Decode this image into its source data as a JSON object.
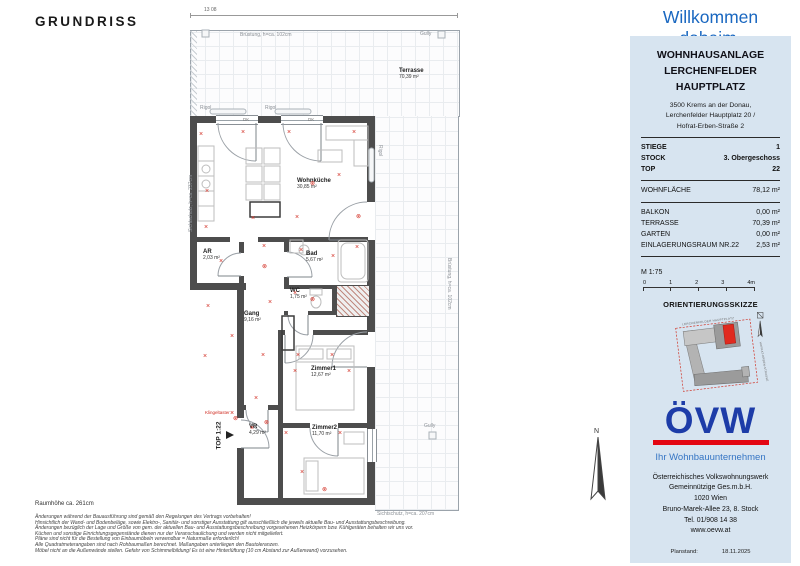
{
  "header": {
    "title": "GRUNDRISS",
    "welcome": "Willkommen daheim."
  },
  "plan": {
    "dimension_top": "13 08",
    "terrace": {
      "name": "Terrasse",
      "area": "70,39 m²"
    },
    "rooms": [
      {
        "name": "Wohnküche",
        "area": "30,85 m²"
      },
      {
        "name": "AR",
        "area": "2,03 m²"
      },
      {
        "name": "Bad",
        "area": "5,67 m²"
      },
      {
        "name": "WC",
        "area": "1,75 m²"
      },
      {
        "name": "Gang",
        "area": "9,16 m²"
      },
      {
        "name": "Zimmer1",
        "area": "12,67 m²"
      },
      {
        "name": "VR",
        "area": "4,29 m²"
      },
      {
        "name": "Zimmer2",
        "area": "11,70 m²"
      }
    ],
    "labels": {
      "bruestung_top": "Brüstung, h=ca. 102cm",
      "sichtschutz_left": "Sichtschutz, h=ca. 237cm",
      "sichtschutz_bottom": "Sichtschutz, h=ca. 207cm",
      "bruestung_right": "Brüstung, h=ca. 102cm",
      "gully": "Gully",
      "rigol": "Rigol",
      "dk": "DK",
      "top_entry": "TOP 1:22",
      "klingel": "Klingeltaster",
      "north": "N"
    }
  },
  "footnotes": {
    "room_height": "Raumhöhe ca. 261cm",
    "lines": [
      "Änderungen während der Bauausführung sind gemäß den Regelungen des Vertrags vorbehalten!",
      "Hinsichtlich der Wand- und Bodenbeläge, sowie Elektro-, Sanitär- und sonstiger Ausstattung gilt ausschließlich die jeweils aktuelle Bau- und Ausstattungsbeschreibung.",
      "Änderungen bezüglich der Lage und Größe von gem. der aktuellen Bau- und Ausstattungsbeschreibung vorgesehenen Heizkörpern bzw. Kühlgeräten behalten wir uns vor.",
      "Küchen und sonstige Einrichtungsgegenstände dienen nur der Veranschaulichung und werden nicht mitgeliefert.",
      "Pläne sind nicht für die Bestellung von Einbaumöbeln verwendbar = Naturmaße erforderlich!",
      "Alle Quadratmeterangaben sind nach Rohbaumaßen berechnet. Maßangaben unterliegen den Bautoleranzen.",
      "Möbel nicht an die Außenwände stellen. Gefahr von Schimmelbildung! Es ist eine Hinterlüftung (10 cm Abstand zur Außenwand) vorzusehen."
    ]
  },
  "panel": {
    "project_line1": "WOHNHAUSANLAGE",
    "project_line2": "LERCHENFELDER HAUPTPLATZ",
    "address": [
      "3500 Krems an der Donau,",
      "Lerchenfelder Hauptplatz 20 /",
      "Hofrat-Erben-Straße 2"
    ],
    "unit_rows": [
      {
        "label": "STIEGE",
        "value": "1"
      },
      {
        "label": "STOCK",
        "value": "3. Obergeschoss"
      },
      {
        "label": "TOP",
        "value": "22"
      }
    ],
    "living_row": {
      "label": "WOHNFLÄCHE",
      "value": "78,12 m²"
    },
    "extra_rows": [
      {
        "label": "BALKON",
        "value": "0,00 m²"
      },
      {
        "label": "TERRASSE",
        "value": "70,39 m²"
      },
      {
        "label": "GARTEN",
        "value": "0,00 m²"
      },
      {
        "label": "EINLAGERUNGSRAUM NR.22",
        "value": "2,53 m²"
      }
    ],
    "scale": {
      "label": "M 1:75",
      "ticks": [
        "0",
        "1",
        "2",
        "3",
        "4m"
      ]
    },
    "orientation": {
      "title": "ORIENTIERUNGSSKIZZE",
      "street_top": "LERCHENFELDER HAUPTPLATZ",
      "street_right": "HOFRAT-ERBEN-STRASSE"
    },
    "logo": {
      "text": "ÖVW",
      "tagline": "Ihr Wohnbauunternehmen"
    },
    "company": [
      "Österreichisches Volkswohnungswerk",
      "Gemeinnützige Ges.m.b.H.",
      "1020 Wien",
      "Bruno-Marek-Allee 23, 8. Stock",
      "Tel. 01/908 14 38",
      "www.oevw.at"
    ],
    "planstand": {
      "label": "Planstand:",
      "value": "18.11.2025"
    }
  },
  "colors": {
    "panel_bg": "#d7e4f0",
    "accent_blue": "#1967c0",
    "logo_blue": "#1d3ca8",
    "logo_red": "#e30613",
    "wall_gray": "#4d4d4d",
    "symbol_red": "#d22c21"
  }
}
